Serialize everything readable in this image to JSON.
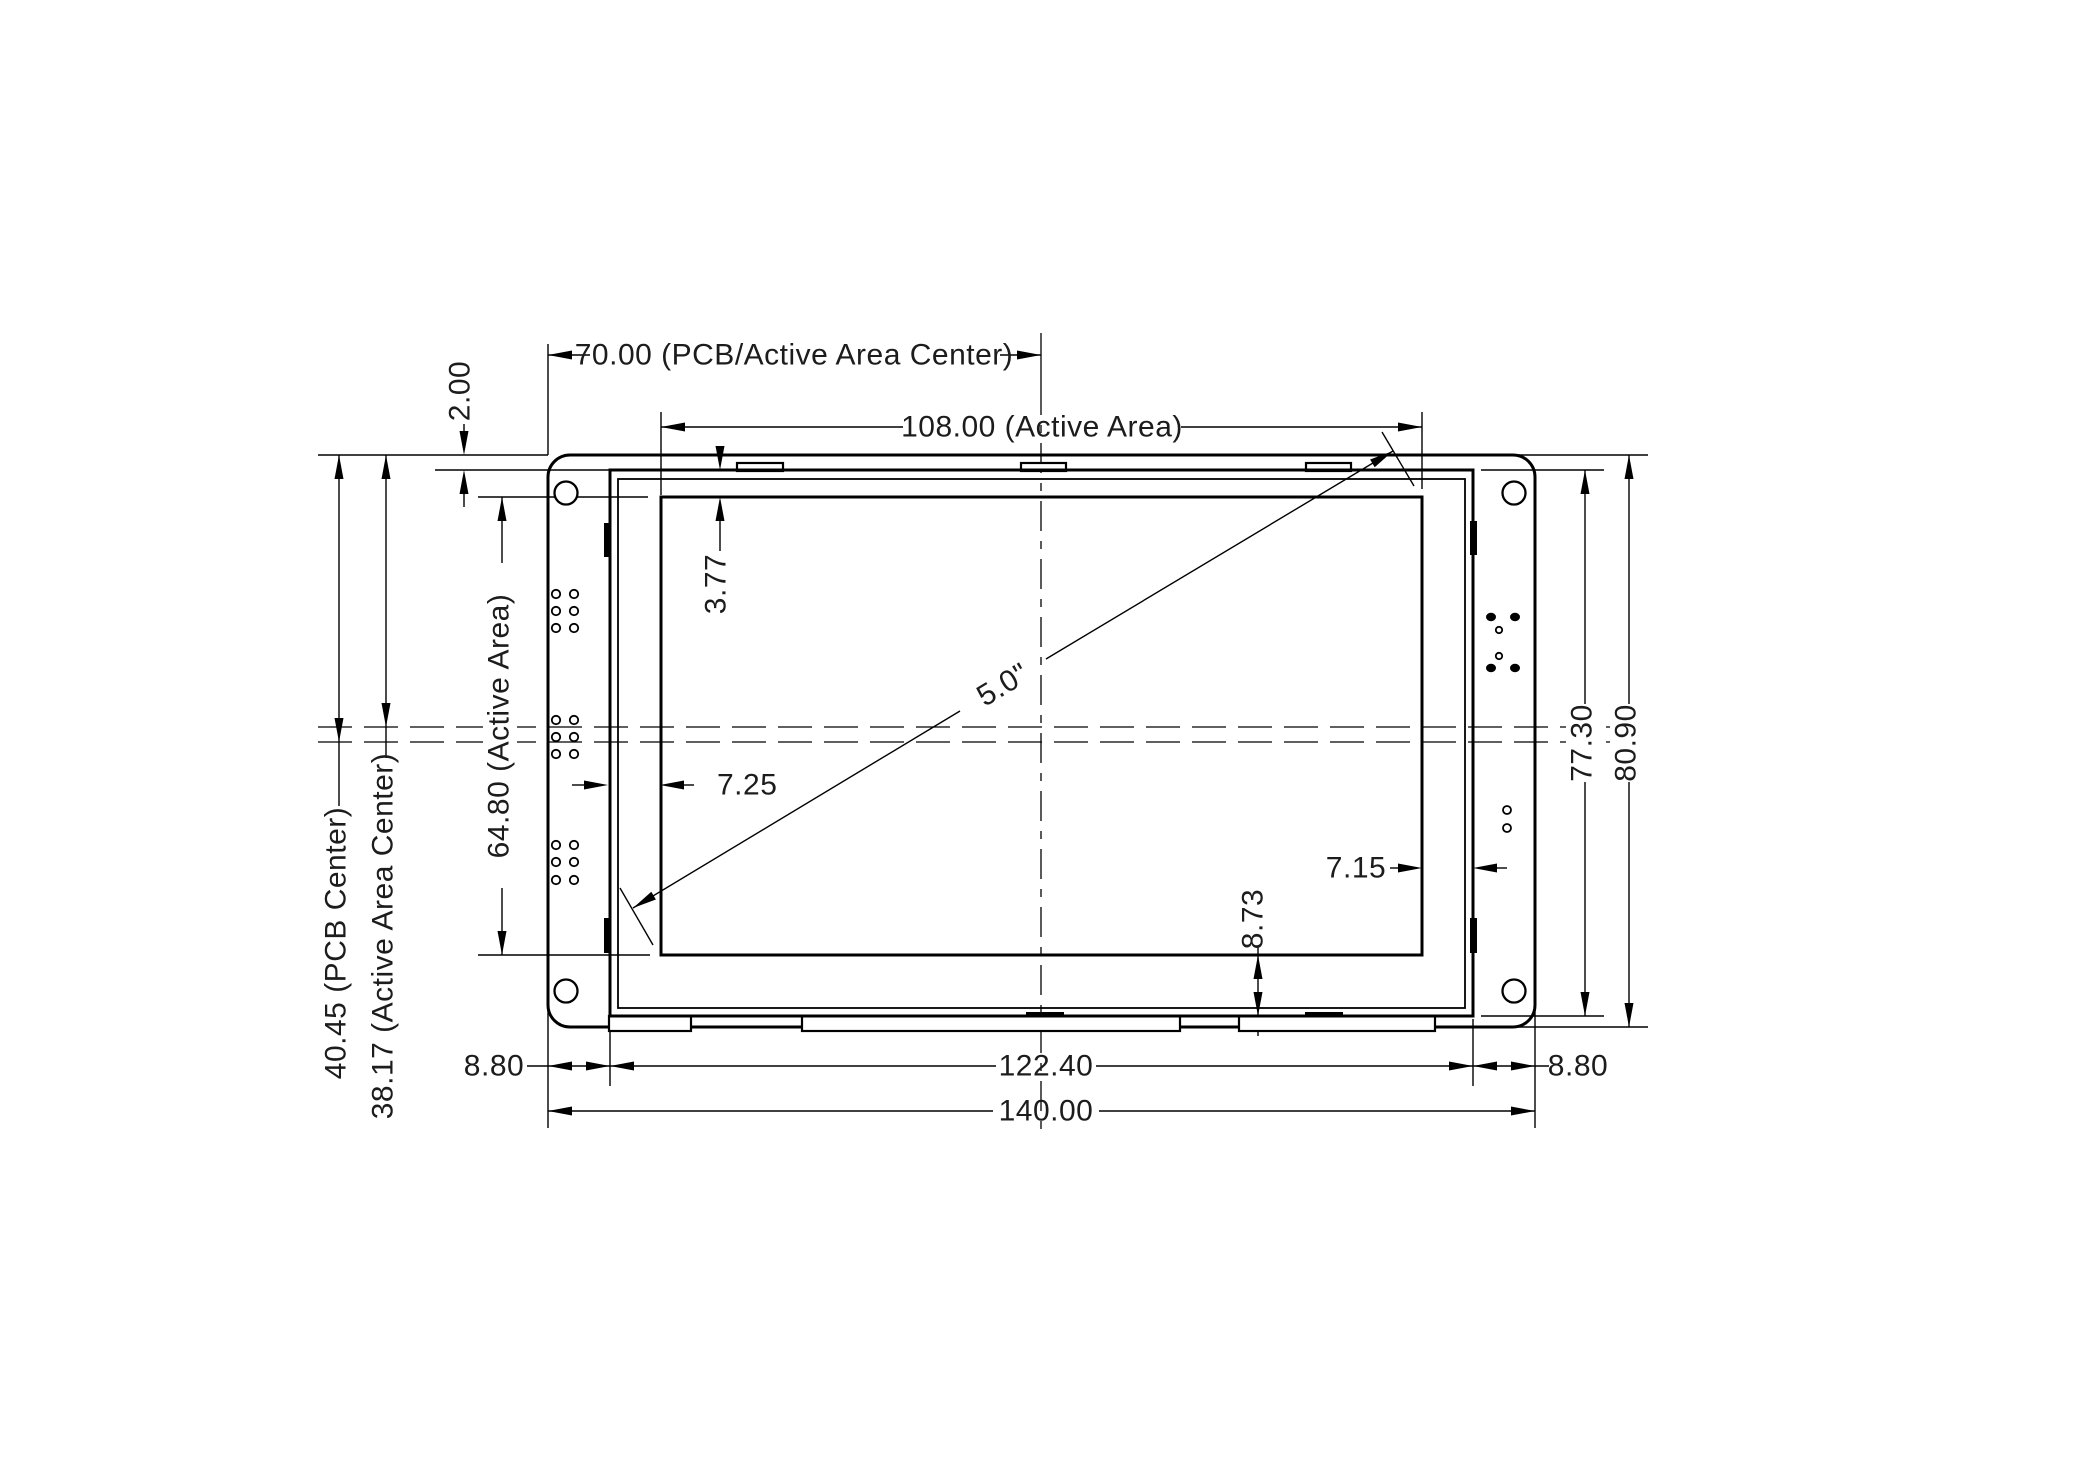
{
  "drawing": {
    "kind": "mechanical dimension drawing",
    "subject": "5.0 inch LCD display module with PCB, front view",
    "units": "mm",
    "background_color": "#ffffff",
    "line_color": "#000000",
    "text_color": "#1c1c1c"
  },
  "labels": {
    "pcb_center_x": "70.00 (PCB/Active Area Center)",
    "active_width": "108.00 (Active Area)",
    "top_gap": "2.00",
    "active_top_offset": "3.77",
    "diagonal": "5.0\"",
    "active_height": "64.80 (Active Area)",
    "pcb_center_y": "40.45 (PCB Center)",
    "active_center_y": "38.17 (Active Area Center)",
    "active_left_offset": "7.25",
    "active_right_offset": "7.15",
    "active_bottom_offset": "8.73",
    "module_height": "77.30",
    "pcb_height": "80.90",
    "margin_left": "8.80",
    "margin_right": "8.80",
    "module_width": "122.40",
    "pcb_width": "140.00"
  },
  "dimensions_mm": {
    "pcb_width": 140.0,
    "pcb_height": 80.9,
    "module_width": 122.4,
    "module_height": 77.3,
    "active_area_width": 108.0,
    "active_area_height": 64.8,
    "pcb_and_active_area_center_from_left": 70.0,
    "pcb_center_from_top": 40.45,
    "active_area_center_from_top": 38.17,
    "pcb_margin_left": 8.8,
    "pcb_margin_right": 8.8,
    "module_top_gap": 2.0,
    "active_area_top_offset": 3.77,
    "active_area_left_offset": 7.25,
    "active_area_right_offset": 7.15,
    "active_area_bottom_offset": 8.73,
    "display_diagonal": "5.0\""
  }
}
